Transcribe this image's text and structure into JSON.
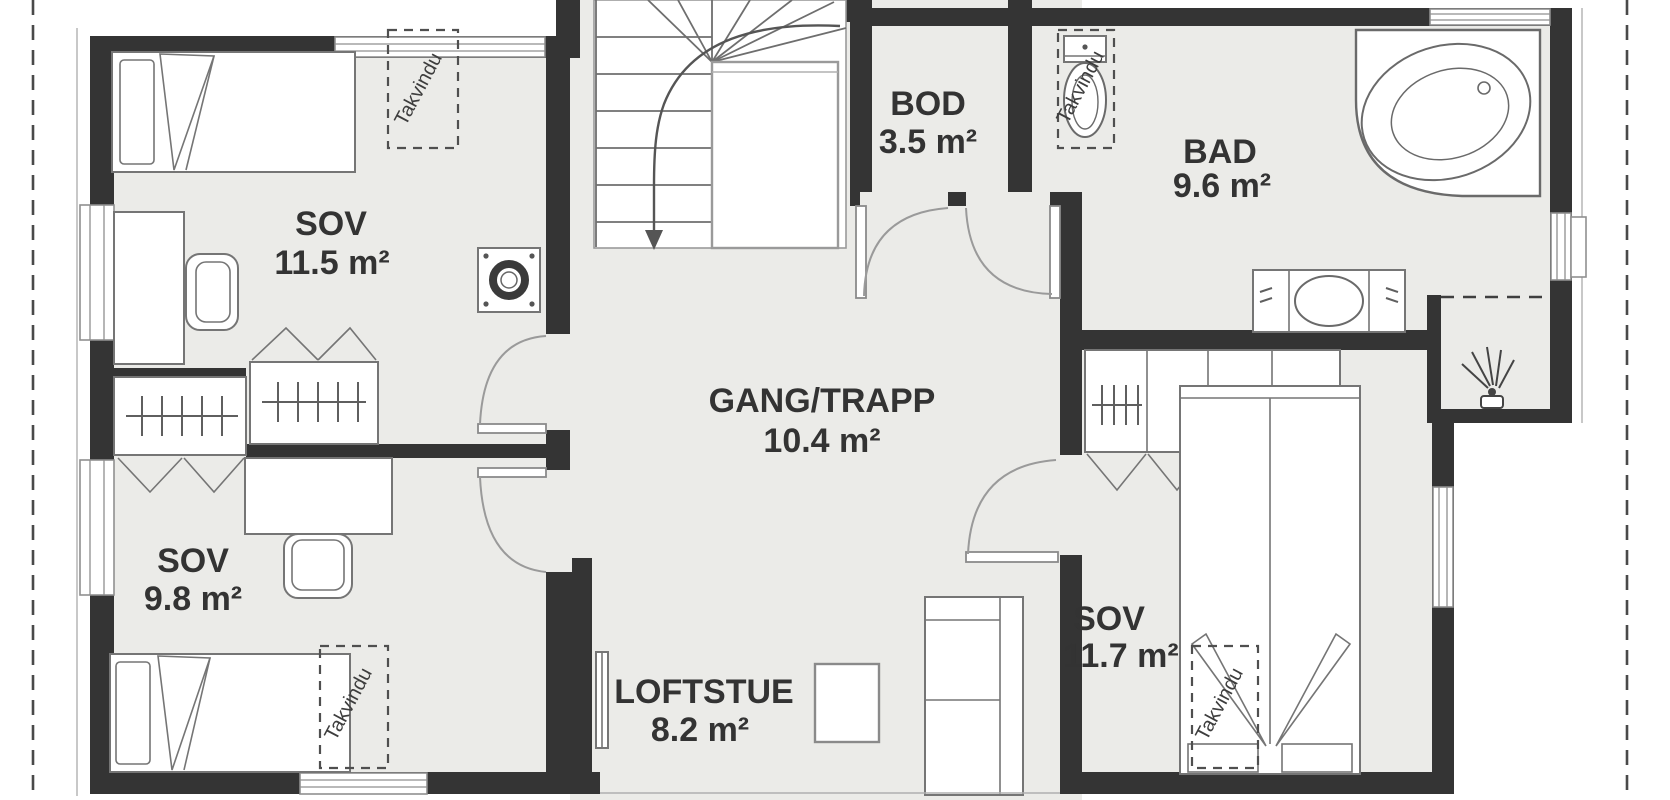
{
  "rooms": [
    {
      "name": "SOV",
      "area": "11.5 m²"
    },
    {
      "name": "SOV",
      "area": "9.8 m²"
    },
    {
      "name": "BOD",
      "area": "3.5 m²"
    },
    {
      "name": "BAD",
      "area": "9.6 m²"
    },
    {
      "name": "GANG/TRAPP",
      "area": "10.4 m²"
    },
    {
      "name": "LOFTSTUE",
      "area": "8.2 m²"
    },
    {
      "name": "SOV",
      "area": "11.7 m²"
    }
  ],
  "skylights": {
    "label": "Takvindu",
    "count": 4
  },
  "fixtures": [
    "single-bed",
    "single-bed",
    "double-bed",
    "desk",
    "desk-chair",
    "wardrobe",
    "toilet",
    "bathtub",
    "vanity-sink",
    "shower-head",
    "sofa",
    "coffee-table",
    "chimney",
    "radiator",
    "staircase-down-arrow"
  ],
  "colors": {
    "wall": "#343434",
    "floor": "#ebebe8",
    "background": "#ffffff",
    "dashed_roofline": "#4a4a4a",
    "text": "#333333"
  }
}
